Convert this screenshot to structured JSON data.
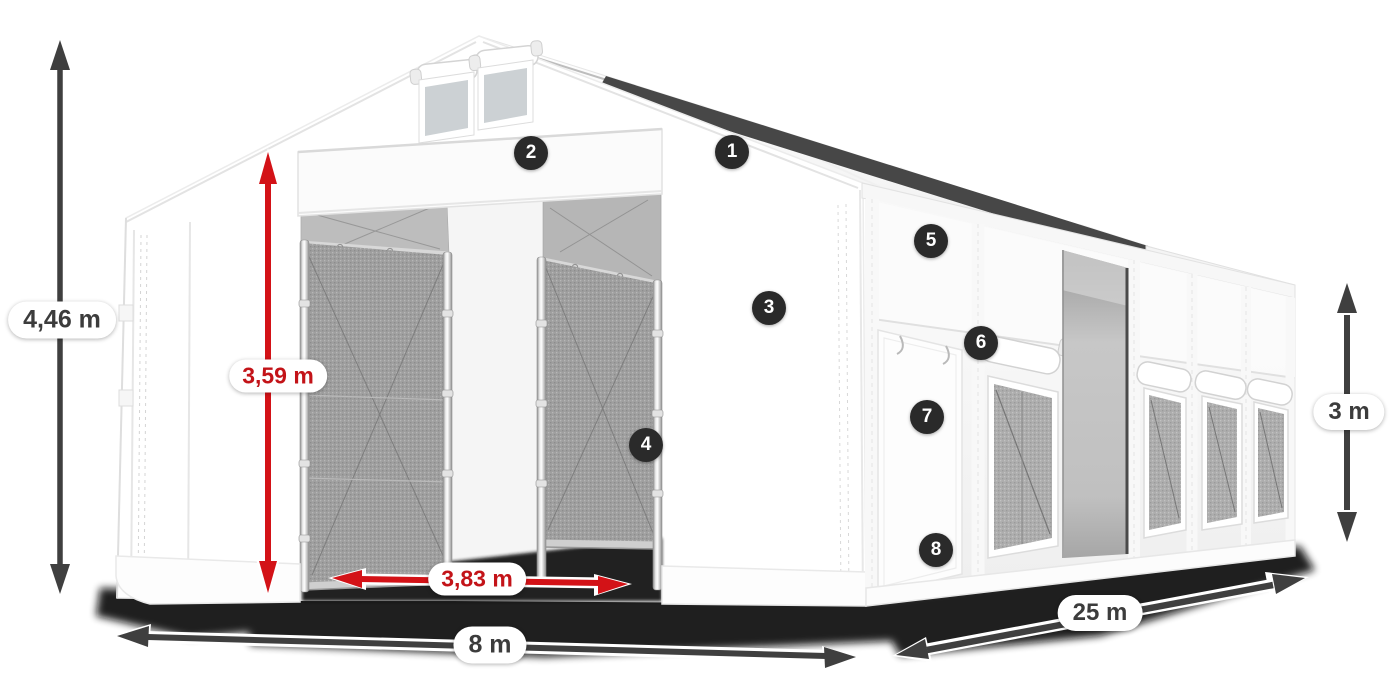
{
  "dimensions": {
    "total_height": "4,46 m",
    "entrance_height": "3,59 m",
    "entrance_width": "3,83 m",
    "front_width": "8 m",
    "side_length": "25 m",
    "wall_height": "3 m"
  },
  "hotspots": [
    "1",
    "2",
    "3",
    "4",
    "5",
    "6",
    "7",
    "8"
  ],
  "colors": {
    "accent_red": "#d31217",
    "red_text": "#c31318",
    "arrow_dark": "#3f3f3f",
    "badge_background": "#2a2a2a",
    "label_text": "#3c3c3c",
    "tent_white": "#ffffff",
    "mesh_gray": "#9f9f9f"
  }
}
